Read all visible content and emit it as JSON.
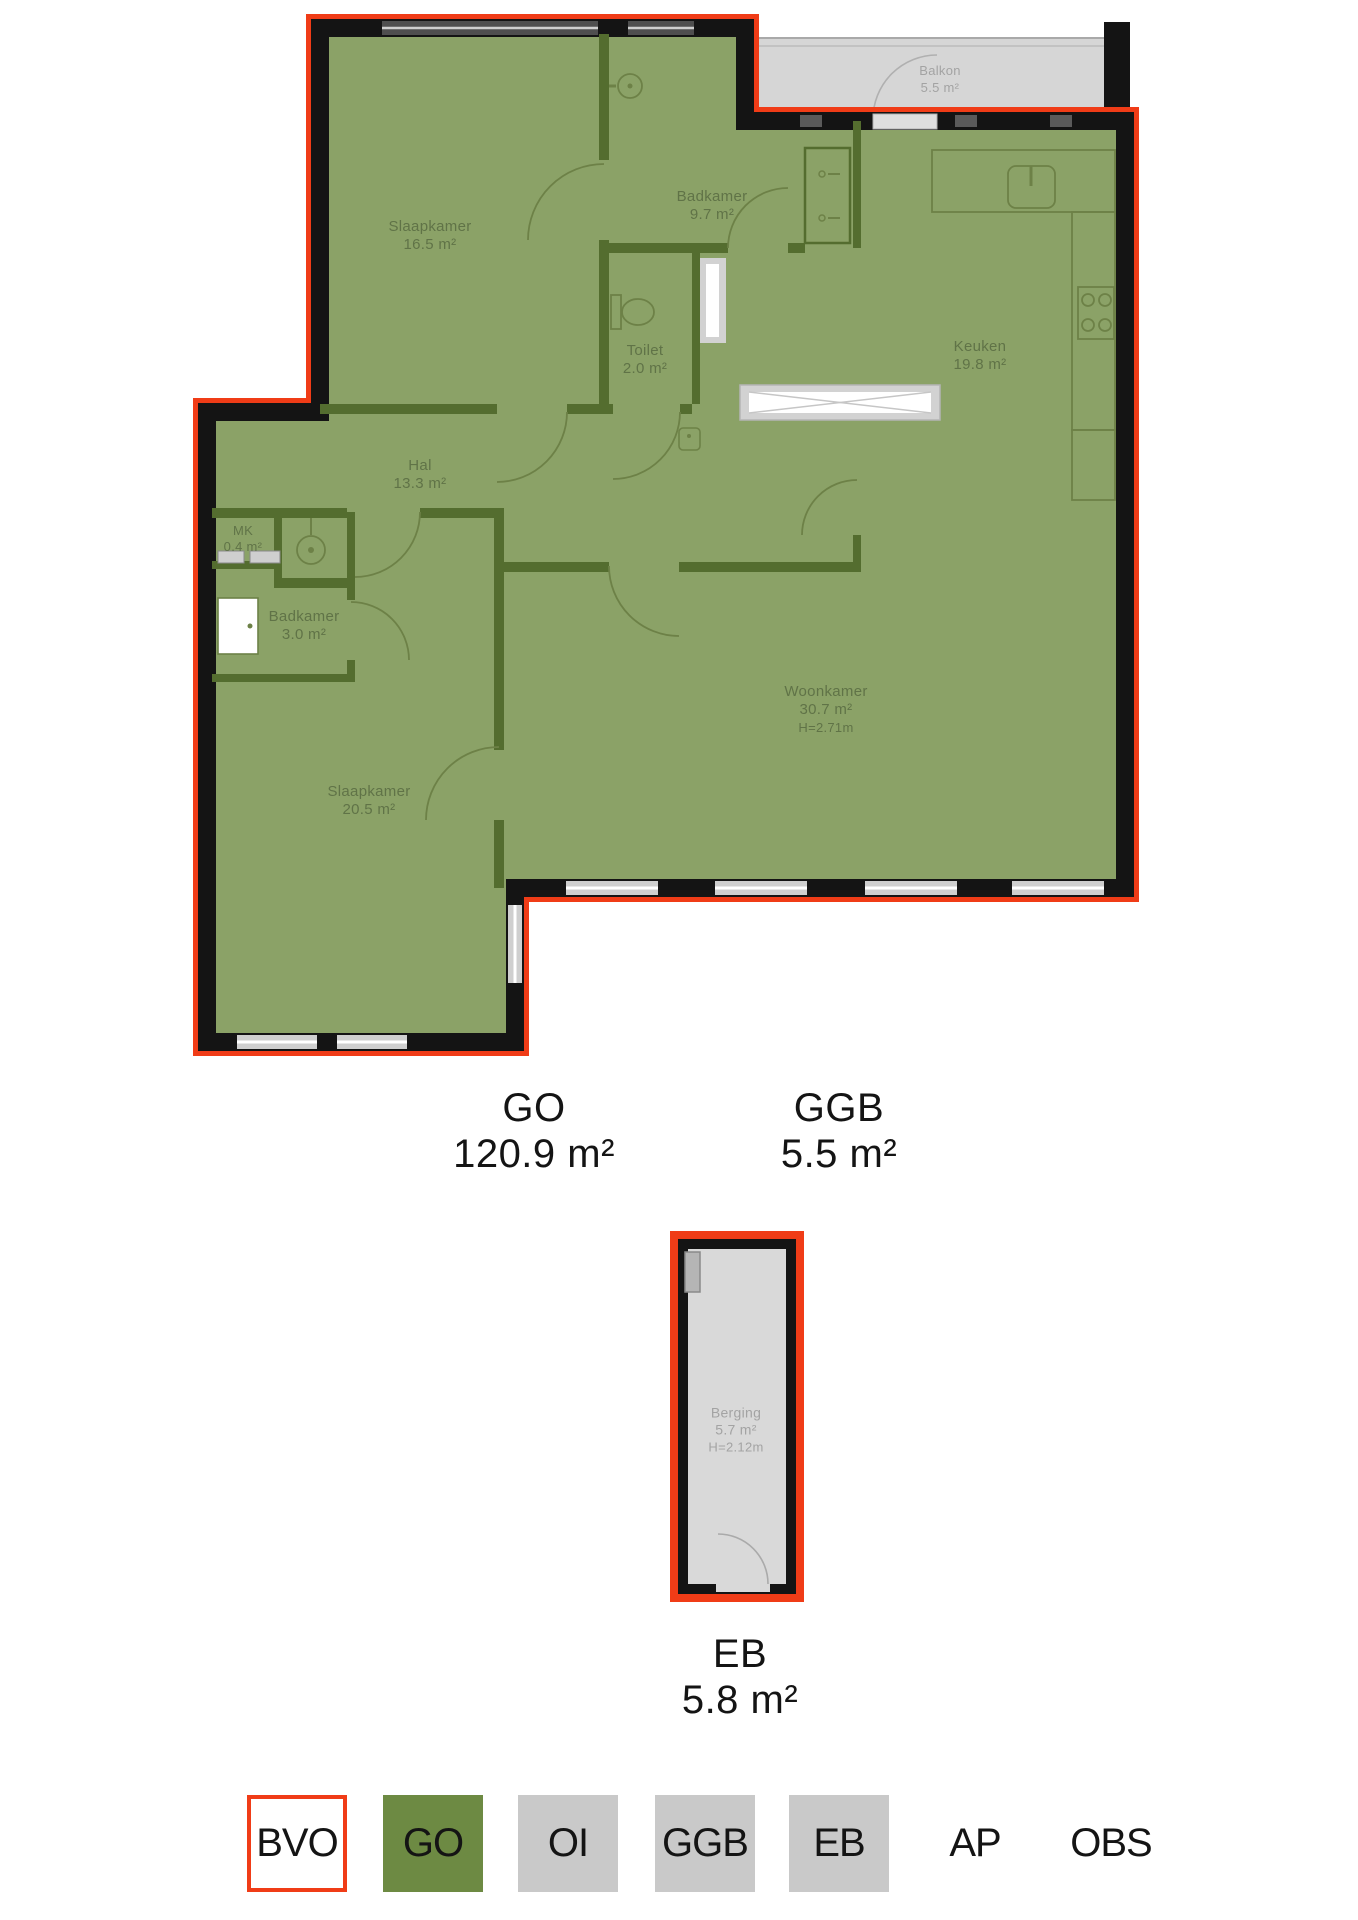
{
  "colors": {
    "bvo_outline_red": "#f03c17",
    "floor_green": "#8ba267",
    "wall_dark_green": "#546d2f",
    "wall_black": "#141414",
    "outdoor_gray": "#d6d6d6",
    "legend_green": "#6d8a43",
    "legend_gray": "#c9c9c9"
  },
  "plan": {
    "rooms": [
      {
        "name": "Slaapkamer",
        "area": "16.5 m²"
      },
      {
        "name": "Badkamer",
        "area": "9.7 m²"
      },
      {
        "name": "Toilet",
        "area": "2.0 m²"
      },
      {
        "name": "Hal",
        "area": "13.3 m²"
      },
      {
        "name": "MK",
        "area": "0.4 m²"
      },
      {
        "name": "Badkamer",
        "area": "3.0 m²"
      },
      {
        "name": "Slaapkamer",
        "area": "20.5 m²"
      },
      {
        "name": "Woonkamer",
        "area": "30.7 m²",
        "height": "H=2.71m"
      },
      {
        "name": "Keuken",
        "area": "19.8 m²"
      },
      {
        "name": "Balkon",
        "area": "5.5 m²"
      }
    ]
  },
  "area_summary": [
    {
      "code": "GO",
      "area": "120.9 m²"
    },
    {
      "code": "GGB",
      "area": "5.5 m²"
    }
  ],
  "storage": {
    "room": {
      "name": "Berging",
      "area": "5.7 m²",
      "height": "H=2.12m"
    },
    "label": {
      "code": "EB",
      "area": "5.8 m²"
    }
  },
  "legend": {
    "items": [
      {
        "code": "BVO"
      },
      {
        "code": "GO"
      },
      {
        "code": "OI"
      },
      {
        "code": "GGB"
      },
      {
        "code": "EB"
      },
      {
        "code": "AP"
      },
      {
        "code": "OBS"
      }
    ]
  }
}
